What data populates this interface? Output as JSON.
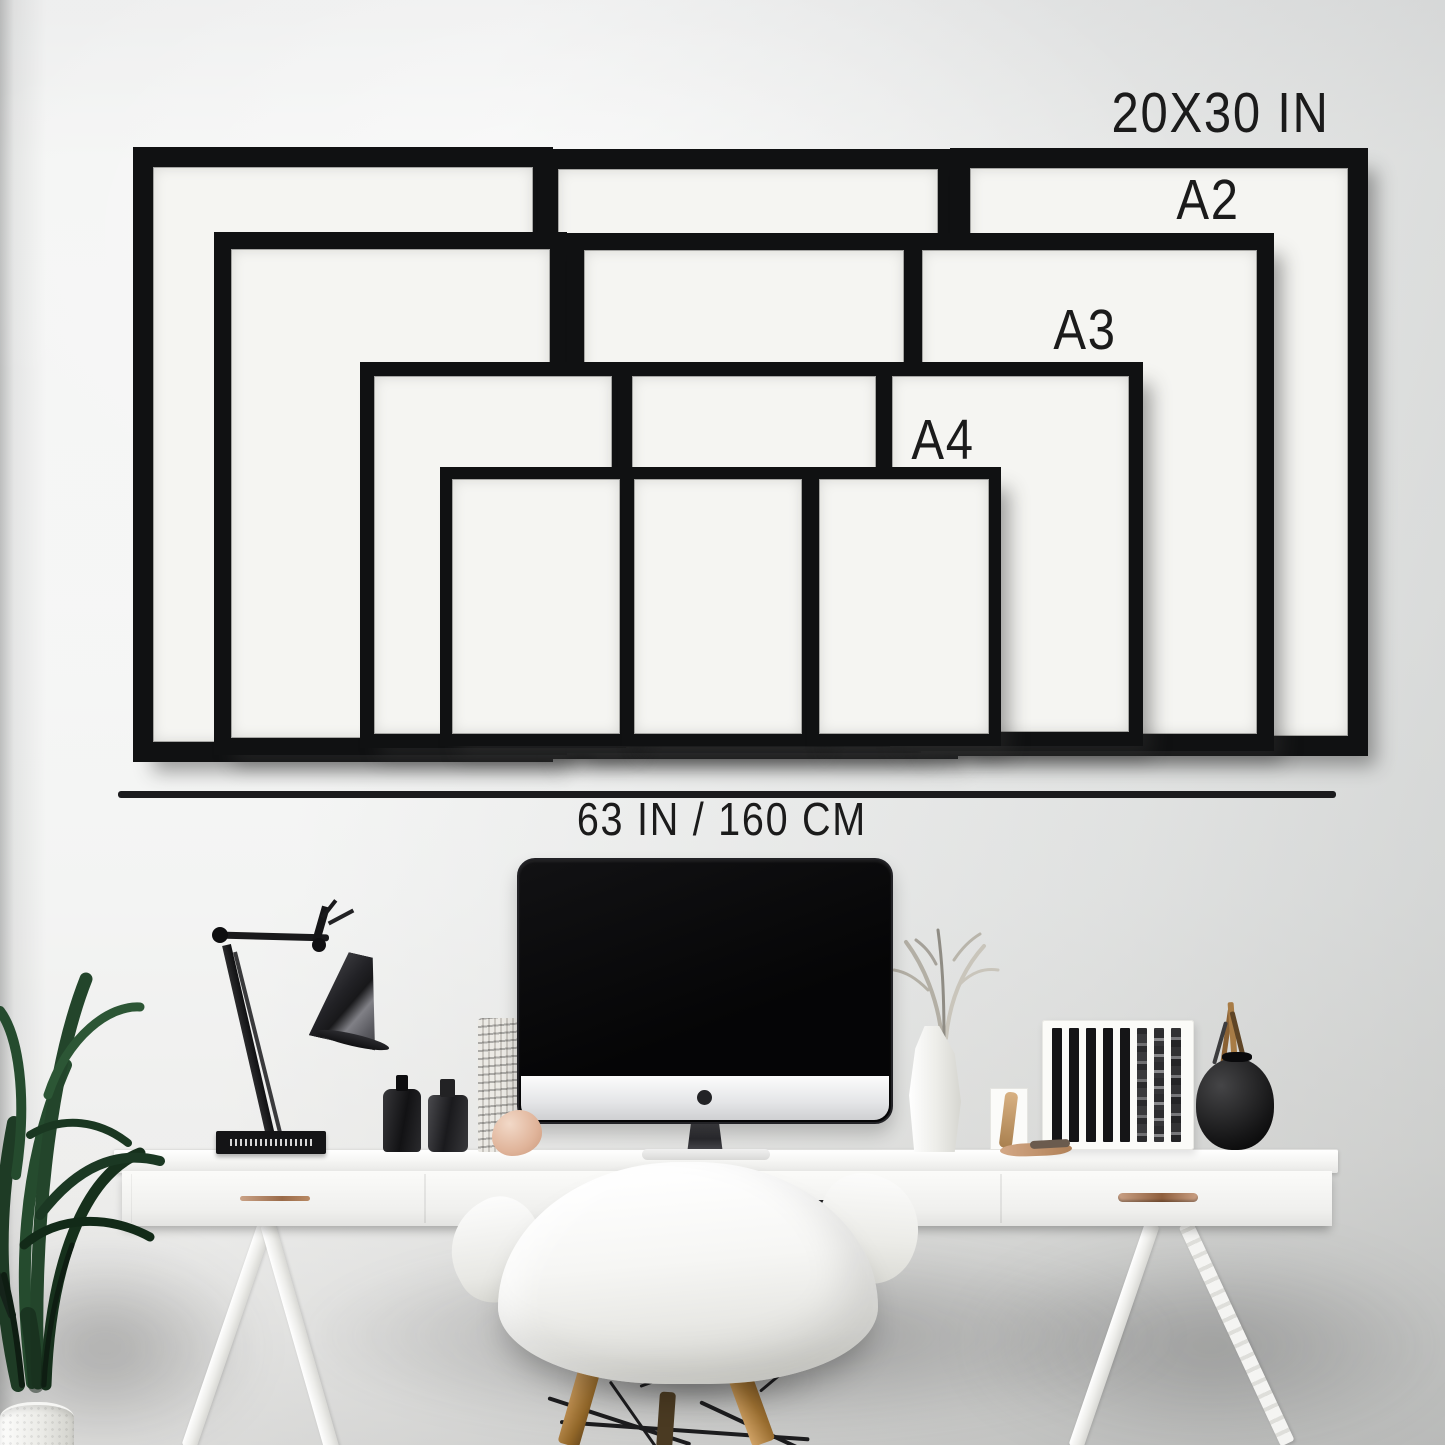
{
  "labels": {
    "size_20x30": "20X30 IN",
    "size_a2": "A2",
    "size_a3": "A3",
    "size_a4": "A4",
    "desk_width": "63 IN / 160 CM"
  },
  "frame_rows": [
    {
      "size_label": "20X30 IN",
      "frame_count": 3
    },
    {
      "size_label": "A2",
      "frame_count": 3
    },
    {
      "size_label": "A3",
      "frame_count": 3
    },
    {
      "size_label": "A4",
      "frame_count": 3
    }
  ],
  "colors": {
    "frame_black": "#101112",
    "mat_white": "#f5f5f2",
    "label_text": "#1b1b1b",
    "divider_line": "#1b1b1d",
    "wall": "#eeefee",
    "desk_white": "#f7f7f5",
    "handle_copper": "#b3795a",
    "plant_green": "#234427",
    "wood_leg": "#b98a52"
  }
}
